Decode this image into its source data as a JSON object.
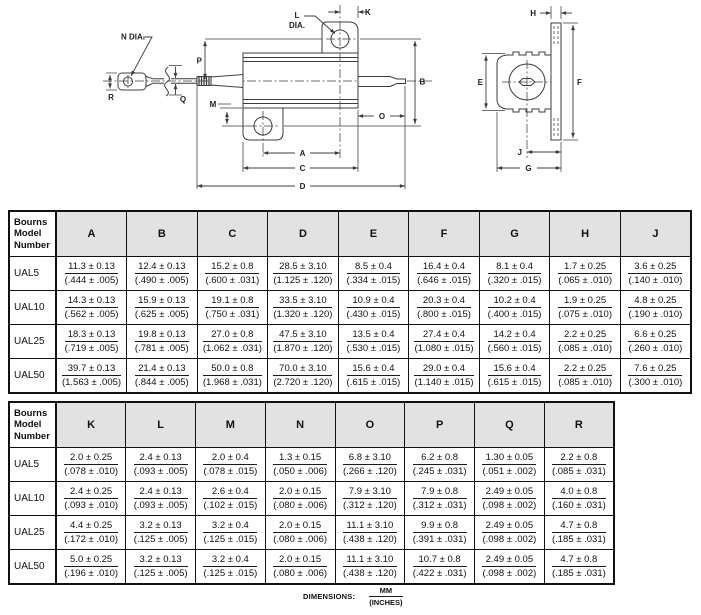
{
  "diagram": {
    "front": {
      "n_dia": "N DIA.",
      "l": "L",
      "dia": "DIA.",
      "k": "K",
      "p": "P",
      "q": "Q",
      "r": "R",
      "m": "M",
      "b": "B",
      "o": "O",
      "a": "A",
      "c": "C",
      "d": "D"
    },
    "side": {
      "h": "H",
      "e": "E",
      "f": "F",
      "j": "J",
      "g": "G"
    }
  },
  "tables": [
    {
      "name": "dimension-table-1",
      "model_header": "Bourns\nModel\nNumber",
      "columns": [
        "A",
        "B",
        "C",
        "D",
        "E",
        "F",
        "G",
        "H",
        "J"
      ],
      "rows": [
        {
          "model": "UAL5",
          "cells": [
            {
              "mm": "11.3 ± 0.13",
              "in": "(.444 ± .005)"
            },
            {
              "mm": "12.4 ± 0.13",
              "in": "(.490 ± .005)"
            },
            {
              "mm": "15.2 ± 0.8",
              "in": "(.600 ± .031)"
            },
            {
              "mm": "28.5 ± 3.10",
              "in": "(1.125 ± .120)"
            },
            {
              "mm": "8.5 ± 0.4",
              "in": "(.334 ± .015)"
            },
            {
              "mm": "16.4 ± 0.4",
              "in": "(.646 ± .015)"
            },
            {
              "mm": "8.1 ± 0.4",
              "in": "(.320 ± .015)"
            },
            {
              "mm": "1.7 ± 0.25",
              "in": "(.065 ± .010)"
            },
            {
              "mm": "3.6 ± 0.25",
              "in": "(.140 ± .010)"
            }
          ]
        },
        {
          "model": "UAL10",
          "cells": [
            {
              "mm": "14.3 ± 0.13",
              "in": "(.562 ± .005)"
            },
            {
              "mm": "15.9 ± 0.13",
              "in": "(.625 ± .005)"
            },
            {
              "mm": "19.1 ± 0.8",
              "in": "(.750 ± .031)"
            },
            {
              "mm": "33.5 ± 3.10",
              "in": "(1.320 ± .120)"
            },
            {
              "mm": "10.9 ± 0.4",
              "in": "(.430 ± .015)"
            },
            {
              "mm": "20.3 ± 0.4",
              "in": "(.800 ± .015)"
            },
            {
              "mm": "10.2 ± 0.4",
              "in": "(.400 ± .015)"
            },
            {
              "mm": "1.9 ± 0.25",
              "in": "(.075 ± .010)"
            },
            {
              "mm": "4.8 ± 0.25",
              "in": "(.190 ± .010)"
            }
          ]
        },
        {
          "model": "UAL25",
          "cells": [
            {
              "mm": "18.3 ± 0.13",
              "in": "(.719 ± .005)"
            },
            {
              "mm": "19.8 ± 0.13",
              "in": "(.781 ± .005)"
            },
            {
              "mm": "27.0 ± 0.8",
              "in": "(1.062 ± .031)"
            },
            {
              "mm": "47.5 ± 3.10",
              "in": "(1.870 ± .120)"
            },
            {
              "mm": "13.5 ± 0.4",
              "in": "(.530 ± .015)"
            },
            {
              "mm": "27.4 ± 0.4",
              "in": "(1.080 ± .015)"
            },
            {
              "mm": "14.2 ± 0.4",
              "in": "(.560 ± .015)"
            },
            {
              "mm": "2.2 ± 0.25",
              "in": "(.085 ± .010)"
            },
            {
              "mm": "6.6 ± 0.25",
              "in": "(.260 ± .010)"
            }
          ]
        },
        {
          "model": "UAL50",
          "cells": [
            {
              "mm": "39.7 ± 0.13",
              "in": "(1.563 ± .005)"
            },
            {
              "mm": "21.4 ± 0.13",
              "in": "(.844 ± .005)"
            },
            {
              "mm": "50.0 ± 0.8",
              "in": "(1.968 ± .031)"
            },
            {
              "mm": "70.0 ± 3.10",
              "in": "(2.720 ± .120)"
            },
            {
              "mm": "15.6 ± 0.4",
              "in": "(.615 ± .015)"
            },
            {
              "mm": "29.0 ± 0.4",
              "in": "(1.140 ± .015)"
            },
            {
              "mm": "15.6 ± 0.4",
              "in": "(.615 ± .015)"
            },
            {
              "mm": "2.2 ± 0.25",
              "in": "(.085 ± .010)"
            },
            {
              "mm": "7.6 ± 0.25",
              "in": "(.300 ± .010)"
            }
          ]
        }
      ]
    },
    {
      "name": "dimension-table-2",
      "model_header": "Bourns\nModel\nNumber",
      "columns": [
        "K",
        "L",
        "M",
        "N",
        "O",
        "P",
        "Q",
        "R"
      ],
      "rows": [
        {
          "model": "UAL5",
          "cells": [
            {
              "mm": "2.0 ± 0.25",
              "in": "(.078 ± .010)"
            },
            {
              "mm": "2.4 ± 0.13",
              "in": "(.093 ± .005)"
            },
            {
              "mm": "2.0 ± 0.4",
              "in": "(.078 ± .015)"
            },
            {
              "mm": "1.3 ± 0.15",
              "in": "(.050 ± .006)"
            },
            {
              "mm": "6.8 ± 3.10",
              "in": "(.266 ± .120)"
            },
            {
              "mm": "6.2 ± 0.8",
              "in": "(.245 ± .031)"
            },
            {
              "mm": "1.30 ± 0.05",
              "in": "(.051 ± .002)"
            },
            {
              "mm": "2.2 ± 0.8",
              "in": "(.085 ± .031)"
            }
          ]
        },
        {
          "model": "UAL10",
          "cells": [
            {
              "mm": "2.4 ± 0.25",
              "in": "(.093 ± .010)"
            },
            {
              "mm": "2.4 ± 0.13",
              "in": "(.093 ± .005)"
            },
            {
              "mm": "2.6 ± 0.4",
              "in": "(.102 ± .015)"
            },
            {
              "mm": "2.0 ± 0.15",
              "in": "(.080 ± .006)"
            },
            {
              "mm": "7.9 ± 3.10",
              "in": "(.312 ± .120)"
            },
            {
              "mm": "7.9 ± 0.8",
              "in": "(.312 ± .031)"
            },
            {
              "mm": "2.49 ± 0.05",
              "in": "(.098 ± .002)"
            },
            {
              "mm": "4.0 ± 0.8",
              "in": "(.160 ± .031)"
            }
          ]
        },
        {
          "model": "UAL25",
          "cells": [
            {
              "mm": "4.4 ± 0.25",
              "in": "(.172 ± .010)"
            },
            {
              "mm": "3.2 ± 0.13",
              "in": "(.125 ± .005)"
            },
            {
              "mm": "3.2 ± 0.4",
              "in": "(.125 ± .015)"
            },
            {
              "mm": "2.0 ± 0.15",
              "in": "(.080 ± .006)"
            },
            {
              "mm": "11.1 ± 3.10",
              "in": "(.438 ± .120)"
            },
            {
              "mm": "9.9 ± 0.8",
              "in": "(.391 ± .031)"
            },
            {
              "mm": "2.49 ± 0.05",
              "in": "(.098 ± .002)"
            },
            {
              "mm": "4.7 ± 0.8",
              "in": "(.185 ± .031)"
            }
          ]
        },
        {
          "model": "UAL50",
          "cells": [
            {
              "mm": "5.0 ± 0.25",
              "in": "(.196 ± .010)"
            },
            {
              "mm": "3.2 ± 0.13",
              "in": "(.125 ± .005)"
            },
            {
              "mm": "3.2 ± 0.4",
              "in": "(.125 ± .015)"
            },
            {
              "mm": "2.0 ± 0.15",
              "in": "(.080 ± .006)"
            },
            {
              "mm": "11.1 ± 3.10",
              "in": "(.438 ± .120)"
            },
            {
              "mm": "10.7 ± 0.8",
              "in": "(.422 ± .031)"
            },
            {
              "mm": "2.49 ± 0.05",
              "in": "(.098 ± .002)"
            },
            {
              "mm": "4.7 ± 0.8",
              "in": "(.185 ± .031)"
            }
          ]
        }
      ]
    }
  ],
  "footer": {
    "label": "DIMENSIONS:",
    "mm": "MM",
    "inches": "(INCHES)"
  }
}
